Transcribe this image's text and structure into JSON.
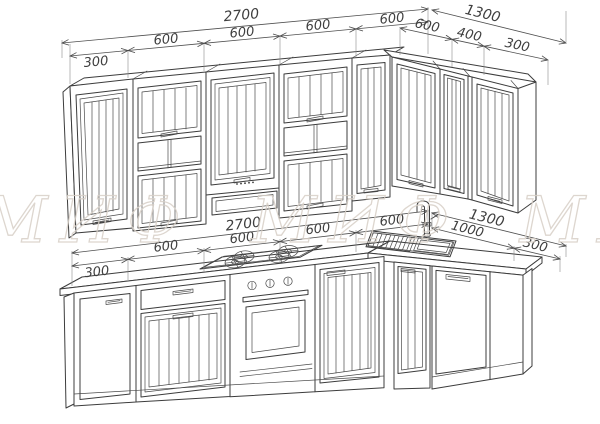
{
  "drawing": {
    "kind": "kitchen cabinet set technical drawing",
    "background": "#ffffff",
    "line_color": "#3c3c3c",
    "dim_color": "#4a4a4a",
    "watermark": {
      "text": "МИФ МИФ МИФ",
      "color": "#d8d0c7"
    }
  },
  "dimensions": {
    "upper_front": {
      "overall": "2700",
      "segments": [
        "300",
        "600",
        "600",
        "600",
        "600"
      ]
    },
    "upper_right": {
      "overall": "1300",
      "segments": [
        "600",
        "400",
        "300"
      ]
    },
    "base_front": {
      "overall": "2700",
      "segments": [
        "300",
        "600",
        "600",
        "600",
        "600"
      ]
    },
    "base_right": {
      "overall": "1300",
      "segments": [
        "1000",
        "300"
      ]
    }
  }
}
